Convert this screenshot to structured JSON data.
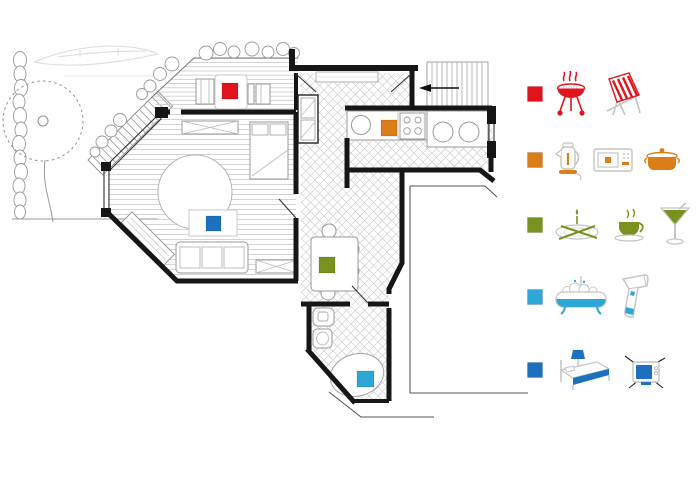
{
  "legend": {
    "items": [
      {
        "name": "terrace-barbecue",
        "color": "#e1131c",
        "icons": [
          "bbq-grill-icon",
          "deck-chair-icon"
        ]
      },
      {
        "name": "kitchen",
        "color": "#dc7e17",
        "icons": [
          "kettle-icon",
          "microwave-icon",
          "cooking-pot-icon"
        ]
      },
      {
        "name": "dining",
        "color": "#79921e",
        "icons": [
          "dinner-setting-icon",
          "coffee-cup-icon",
          "cocktail-icon"
        ]
      },
      {
        "name": "bathroom",
        "color": "#2ea7d8",
        "icons": [
          "bathtub-icon",
          "hairdryer-icon"
        ]
      },
      {
        "name": "sleeping-living",
        "color": "#1d6fc0",
        "icons": [
          "bed-icon",
          "tv-icon"
        ]
      }
    ]
  },
  "floorplan": {
    "markers": [
      {
        "name": "terrace-marker",
        "color": "#e1131c"
      },
      {
        "name": "kitchen-marker",
        "color": "#dc7e17"
      },
      {
        "name": "dining-marker",
        "color": "#79921e"
      },
      {
        "name": "bathroom-marker",
        "color": "#2ea7d8"
      },
      {
        "name": "living-marker",
        "color": "#1d6fc0"
      }
    ]
  }
}
